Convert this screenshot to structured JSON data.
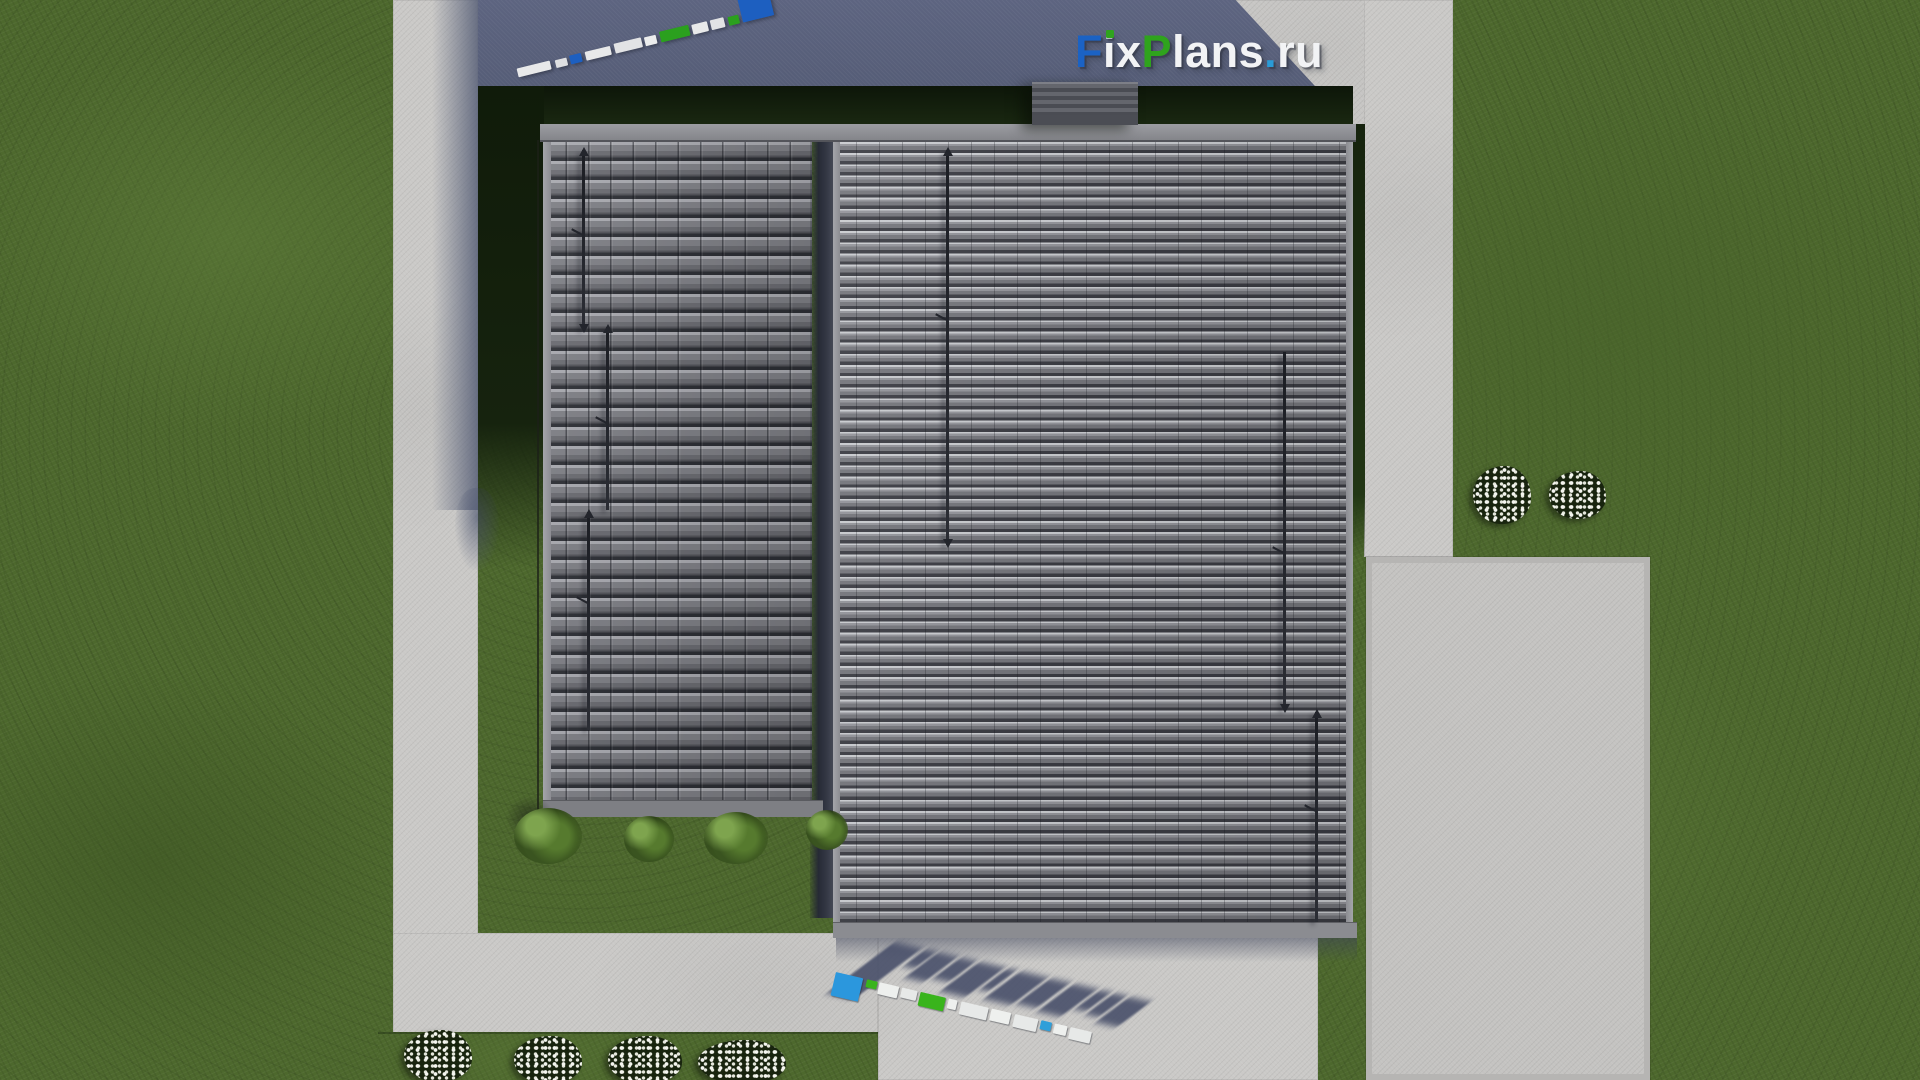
{
  "branding": {
    "logo": {
      "text": "FixPlans.ru",
      "parts": [
        {
          "t": "F",
          "color": "#1b62c4"
        },
        {
          "t": "i",
          "color": "#f2f3f5",
          "dot_color": "#2fa31d"
        },
        {
          "t": "x",
          "color": "#f2f3f5"
        },
        {
          "t": "P",
          "color": "#2fa31d"
        },
        {
          "t": "lans",
          "color": "#f2f3f5"
        },
        {
          "t": ".",
          "color": "#2a9bd6"
        },
        {
          "t": "ru",
          "color": "#f2f3f5"
        }
      ]
    },
    "watermark_top": {
      "represents": "FixPlans.ru (foreshortened ground watermark)",
      "segments": [
        {
          "c": "#e8e9ea",
          "w": 34,
          "h": 9,
          "g": 0
        },
        {
          "c": "#dfe0e2",
          "w": 12,
          "h": 8,
          "g": 5
        },
        {
          "c": "#1d5fc0",
          "w": 12,
          "h": 9,
          "g": 3
        },
        {
          "c": "#e8e9ea",
          "w": 26,
          "h": 9,
          "g": 4
        },
        {
          "c": "#e2e3e5",
          "w": 28,
          "h": 10,
          "g": 4
        },
        {
          "c": "#eceded",
          "w": 12,
          "h": 9,
          "g": 3
        },
        {
          "c": "#2ba01e",
          "w": 30,
          "h": 11,
          "g": 4
        },
        {
          "c": "#e8e9ea",
          "w": 16,
          "h": 10,
          "g": 3
        },
        {
          "c": "#e2e3e5",
          "w": 14,
          "h": 10,
          "g": 3
        },
        {
          "c": "#2ba01e",
          "w": 11,
          "h": 9,
          "g": 4
        },
        {
          "c": "#1d5fc0",
          "w": 32,
          "h": 24,
          "g": 3
        }
      ]
    },
    "watermark_bottom": {
      "represents": "FixPlans.ru (extruded 3D ground watermark with cast shadow)",
      "shadow_color": "#49506a",
      "segments": [
        {
          "c": "#2b97dd",
          "w": 28,
          "h": 24,
          "g": 0
        },
        {
          "c": "#39b41c",
          "w": 11,
          "h": 8,
          "g": 4
        },
        {
          "c": "#eef0ee",
          "w": 20,
          "h": 12,
          "g": 2
        },
        {
          "c": "#e7e9e8",
          "w": 16,
          "h": 10,
          "g": 3
        },
        {
          "c": "#39b41c",
          "w": 26,
          "h": 14,
          "g": 3
        },
        {
          "c": "#eef0ee",
          "w": 9,
          "h": 10,
          "g": 3
        },
        {
          "c": "#e7e9e8",
          "w": 28,
          "h": 13,
          "g": 4
        },
        {
          "c": "#eef0ee",
          "w": 20,
          "h": 12,
          "g": 3
        },
        {
          "c": "#e7e9e8",
          "w": 24,
          "h": 13,
          "g": 4
        },
        {
          "c": "#2f9fd9",
          "w": 11,
          "h": 9,
          "g": 3
        },
        {
          "c": "#eef0ee",
          "w": 13,
          "h": 10,
          "g": 3
        },
        {
          "c": "#e7e9e8",
          "w": 22,
          "h": 12,
          "g": 3
        }
      ]
    }
  },
  "palette": {
    "grass": "#4d682d",
    "concrete_path": "#cac9c7",
    "driveway": "#c4c3c1",
    "roof_tile_left": "#7e7f85",
    "roof_rib_highlight": "#c9cbcf",
    "roof_dark_gap": "#3b3c43",
    "building_shadow": "#565e78",
    "garden_shadow": "#141f0c",
    "logo_blue": "#1b62c4",
    "logo_green": "#2fa31d",
    "flower_white": "#f4f5ef"
  }
}
